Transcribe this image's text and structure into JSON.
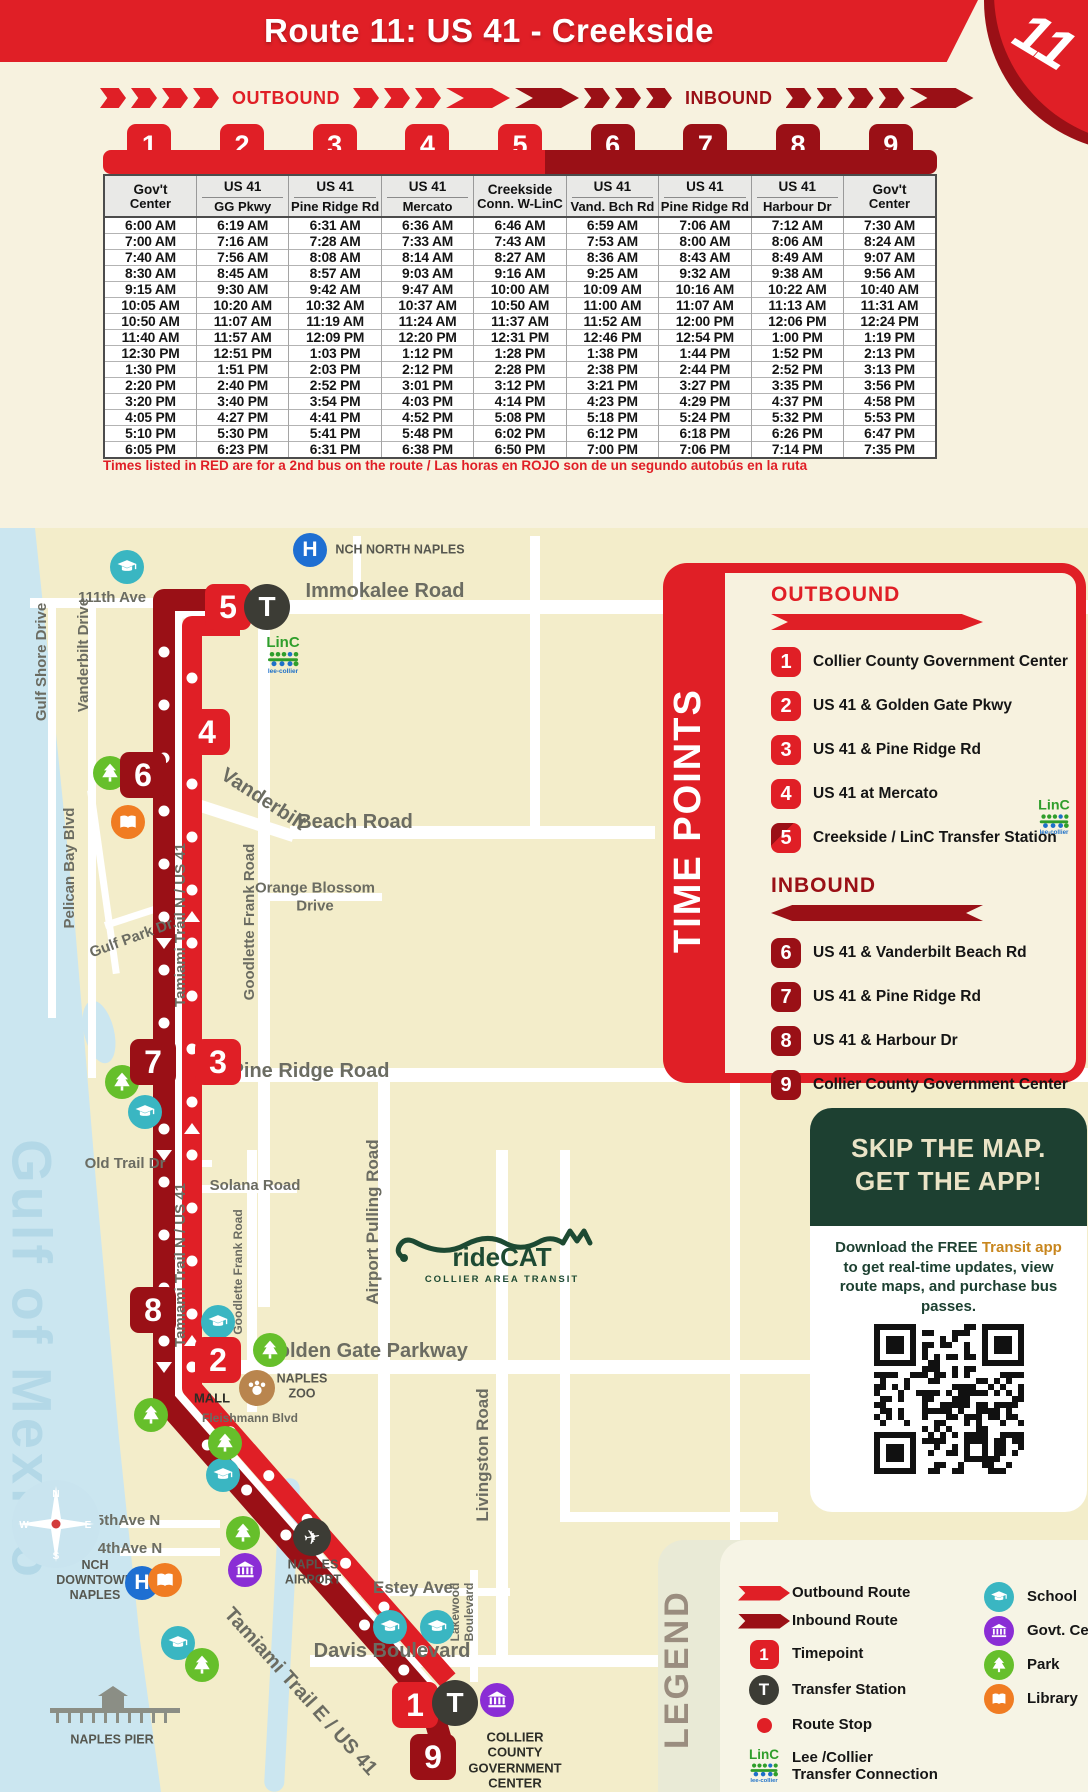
{
  "header": {
    "title": "Route 11: US 41 - Creekside",
    "route_number": "11"
  },
  "directions": {
    "outbound": "OUTBOUND",
    "inbound": "INBOUND"
  },
  "schedule": {
    "columns": [
      {
        "num": "1",
        "tone": "bright",
        "title": "Gov't",
        "subtitle": "Center",
        "divider": false
      },
      {
        "num": "2",
        "tone": "bright",
        "title": "US 41",
        "subtitle": "GG Pkwy",
        "divider": true
      },
      {
        "num": "3",
        "tone": "bright",
        "title": "US 41",
        "subtitle": "Pine Ridge Rd",
        "divider": true
      },
      {
        "num": "4",
        "tone": "bright",
        "title": "US 41",
        "subtitle": "Mercato",
        "divider": true
      },
      {
        "num": "5",
        "tone": "bright",
        "title": "Creekside",
        "subtitle": "Conn. W-LinC",
        "divider": false
      },
      {
        "num": "6",
        "tone": "dark",
        "title": "US 41",
        "subtitle": "Vand. Bch Rd",
        "divider": true
      },
      {
        "num": "7",
        "tone": "dark",
        "title": "US 41",
        "subtitle": "Pine Ridge Rd",
        "divider": true
      },
      {
        "num": "8",
        "tone": "dark",
        "title": "US 41",
        "subtitle": "Harbour Dr",
        "divider": true
      },
      {
        "num": "9",
        "tone": "dark",
        "title": "Gov't",
        "subtitle": "Center",
        "divider": false
      }
    ],
    "rows": [
      {
        "tone": "black",
        "times": [
          "6:00 AM",
          "6:19 AM",
          "6:31 AM",
          "6:36 AM",
          "6:46 AM",
          "6:59 AM",
          "7:06 AM",
          "7:12 AM",
          "7:30 AM"
        ]
      },
      {
        "tone": "red",
        "times": [
          "7:00 AM",
          "7:16 AM",
          "7:28 AM",
          "7:33 AM",
          "7:43 AM",
          "7:53 AM",
          "8:00 AM",
          "8:06 AM",
          "8:24 AM"
        ]
      },
      {
        "tone": "black",
        "times": [
          "7:40 AM",
          "7:56 AM",
          "8:08 AM",
          "8:14 AM",
          "8:27 AM",
          "8:36 AM",
          "8:43 AM",
          "8:49 AM",
          "9:07 AM"
        ]
      },
      {
        "tone": "red",
        "times": [
          "8:30 AM",
          "8:45 AM",
          "8:57 AM",
          "9:03 AM",
          "9:16 AM",
          "9:25 AM",
          "9:32 AM",
          "9:38 AM",
          "9:56 AM"
        ]
      },
      {
        "tone": "black",
        "times": [
          "9:15 AM",
          "9:30 AM",
          "9:42 AM",
          "9:47 AM",
          "10:00 AM",
          "10:09 AM",
          "10:16 AM",
          "10:22 AM",
          "10:40 AM"
        ]
      },
      {
        "tone": "red",
        "times": [
          "10:05 AM",
          "10:20 AM",
          "10:32 AM",
          "10:37 AM",
          "10:50 AM",
          "11:00 AM",
          "11:07 AM",
          "11:13 AM",
          "11:31 AM"
        ]
      },
      {
        "tone": "black",
        "times": [
          "10:50 AM",
          "11:07 AM",
          "11:19 AM",
          "11:24 AM",
          "11:37 AM",
          "11:52 AM",
          "12:00 PM",
          "12:06 PM",
          "12:24 PM"
        ]
      },
      {
        "tone": "red",
        "times": [
          "11:40 AM",
          "11:57 AM",
          "12:09 PM",
          "12:20 PM",
          "12:31 PM",
          "12:46 PM",
          "12:54 PM",
          "1:00 PM",
          "1:19 PM"
        ]
      },
      {
        "tone": "black",
        "times": [
          "12:30 PM",
          "12:51 PM",
          "1:03 PM",
          "1:12 PM",
          "1:28 PM",
          "1:38 PM",
          "1:44 PM",
          "1:52 PM",
          "2:13 PM"
        ]
      },
      {
        "tone": "red",
        "times": [
          "1:30 PM",
          "1:51 PM",
          "2:03 PM",
          "2:12 PM",
          "2:28 PM",
          "2:38 PM",
          "2:44 PM",
          "2:52 PM",
          "3:13 PM"
        ]
      },
      {
        "tone": "black",
        "times": [
          "2:20 PM",
          "2:40 PM",
          "2:52 PM",
          "3:01 PM",
          "3:12 PM",
          "3:21 PM",
          "3:27 PM",
          "3:35 PM",
          "3:56 PM"
        ]
      },
      {
        "tone": "red",
        "times": [
          "3:20 PM",
          "3:40 PM",
          "3:54 PM",
          "4:03 PM",
          "4:14 PM",
          "4:23 PM",
          "4:29 PM",
          "4:37 PM",
          "4:58 PM"
        ]
      },
      {
        "tone": "black",
        "times": [
          "4:05 PM",
          "4:27 PM",
          "4:41 PM",
          "4:52 PM",
          "5:08 PM",
          "5:18 PM",
          "5:24 PM",
          "5:32 PM",
          "5:53 PM"
        ]
      },
      {
        "tone": "red",
        "times": [
          "5:10 PM",
          "5:30 PM",
          "5:41 PM",
          "5:48 PM",
          "6:02 PM",
          "6:12 PM",
          "6:18 PM",
          "6:26 PM",
          "6:47 PM"
        ]
      },
      {
        "tone": "black",
        "times": [
          "6:05 PM",
          "6:23 PM",
          "6:31 PM",
          "6:38 PM",
          "6:50 PM",
          "7:00 PM",
          "7:06 PM",
          "7:14 PM",
          "7:35 PM"
        ]
      }
    ],
    "footnote": "Times listed in RED are for a 2nd bus on the route / Las horas en ROJO son de un segundo autobús en la ruta"
  },
  "time_points_panel": {
    "title": "TIME POINTS",
    "outbound_heading": "OUTBOUND",
    "inbound_heading": "INBOUND",
    "outbound": [
      {
        "num": "1",
        "label": "Collier County Government Center"
      },
      {
        "num": "2",
        "label": "US 41 & Golden Gate Pkwy"
      },
      {
        "num": "3",
        "label": "US 41 & Pine Ridge Rd"
      },
      {
        "num": "4",
        "label": "US 41 at Mercato"
      },
      {
        "num": "5",
        "label": "Creekside / LinC Transfer Station",
        "linc": true
      }
    ],
    "inbound": [
      {
        "num": "6",
        "label": "US 41 & Vanderbilt Beach Rd"
      },
      {
        "num": "7",
        "label": "US 41 & Pine Ridge Rd"
      },
      {
        "num": "8",
        "label": "US 41 & Harbour Dr"
      },
      {
        "num": "9",
        "label": "Collier County Government Center"
      }
    ]
  },
  "app_box": {
    "title_line1": "SKIP THE MAP.",
    "title_line2": "GET THE APP!",
    "body_prefix": "Download the FREE ",
    "body_highlight": "Transit app",
    "body_suffix": " to get real-time updates, view route maps, and purchase bus passes."
  },
  "legend": {
    "title": "LEGEND",
    "left": [
      {
        "icon": "outbound-arrow",
        "label": "Outbound Route"
      },
      {
        "icon": "inbound-arrow",
        "label": "Inbound Route"
      },
      {
        "icon": "timepoint",
        "label": "Timepoint",
        "glyph": "1"
      },
      {
        "icon": "transfer",
        "label": "Transfer Station",
        "glyph": "T"
      },
      {
        "icon": "stop",
        "label": "Route Stop"
      },
      {
        "icon": "linc",
        "label": "Lee /Collier\nTransfer Connection"
      }
    ],
    "right": [
      {
        "icon": "school",
        "label": "School"
      },
      {
        "icon": "govt",
        "label": "Govt. Center"
      },
      {
        "icon": "park",
        "label": "Park"
      },
      {
        "icon": "library",
        "label": "Library"
      }
    ]
  },
  "linc": {
    "word": "LinC",
    "sub": "lee-collier"
  },
  "ridecat": {
    "name": "rideCAT",
    "sub": "COLLIER AREA TRANSIT"
  },
  "map": {
    "water_name": "Gulf of Mexico",
    "compass": {
      "n": "N",
      "e": "E",
      "s": "S",
      "w": "W"
    },
    "labels": [
      {
        "text": "NCH NORTH NAPLES",
        "x": 400,
        "y": 550,
        "cls": "poi"
      },
      {
        "text": "111th Ave",
        "x": 112,
        "y": 598,
        "cls": "st"
      },
      {
        "text": "Immokalee Road",
        "x": 385,
        "y": 592,
        "cls": "st-lg"
      },
      {
        "text": "Gulf Shore Drive",
        "x": 42,
        "y": 662,
        "cls": "st",
        "rot": -90
      },
      {
        "text": "Vanderbilt Drive",
        "x": 84,
        "y": 655,
        "cls": "st",
        "rot": -90
      },
      {
        "text": "Vanderbilt",
        "x": 263,
        "y": 800,
        "cls": "st-lg",
        "rot": 33
      },
      {
        "text": "Beach Road",
        "x": 355,
        "y": 823,
        "cls": "st-lg"
      },
      {
        "text": "Pelican Bay Blvd",
        "x": 70,
        "y": 868,
        "cls": "st",
        "rot": -90
      },
      {
        "text": "Gulf Park Dr.",
        "x": 133,
        "y": 938,
        "cls": "st",
        "rot": -20
      },
      {
        "text": "Tamiami Trail N / US 41",
        "x": 181,
        "y": 925,
        "cls": "st",
        "rot": -90
      },
      {
        "text": "Goodlette Frank Road",
        "x": 250,
        "y": 922,
        "cls": "st",
        "rot": -90
      },
      {
        "text": "Orange Blossom\nDrive",
        "x": 315,
        "y": 897,
        "cls": "st"
      },
      {
        "text": "Pine Ridge Road",
        "x": 310,
        "y": 1072,
        "cls": "st-lg"
      },
      {
        "text": "Old Trail Dr",
        "x": 125,
        "y": 1164,
        "cls": "st"
      },
      {
        "text": "Solana Road",
        "x": 255,
        "y": 1186,
        "cls": "st"
      },
      {
        "text": "Tamiami Trail N / US 41",
        "x": 181,
        "y": 1265,
        "cls": "st",
        "rot": -90
      },
      {
        "text": "Goodlette Frank Road",
        "x": 238,
        "y": 1272,
        "cls": "st-xs",
        "rot": -90
      },
      {
        "text": "Airport Pulling Road",
        "x": 373,
        "y": 1222,
        "cls": "st-md",
        "rot": -90
      },
      {
        "text": "Golden Gate Parkway",
        "x": 365,
        "y": 1352,
        "cls": "st-lg"
      },
      {
        "text": "NAPLES\nZOO",
        "x": 302,
        "y": 1386,
        "cls": "poi"
      },
      {
        "text": "MALL",
        "x": 212,
        "y": 1398,
        "cls": "poi-dark"
      },
      {
        "text": "Fleishmann Blvd",
        "x": 250,
        "y": 1418,
        "cls": "st-xs"
      },
      {
        "text": "Livingston Road",
        "x": 483,
        "y": 1455,
        "cls": "st-md",
        "rot": -90
      },
      {
        "text": "5thAve N",
        "x": 128,
        "y": 1521,
        "cls": "st"
      },
      {
        "text": "4thAve N",
        "x": 130,
        "y": 1549,
        "cls": "st"
      },
      {
        "text": "NCH\nDOWNTOWN\nNAPLES",
        "x": 95,
        "y": 1580,
        "cls": "poi"
      },
      {
        "text": "NAPLES\nAIRPORT",
        "x": 313,
        "y": 1572,
        "cls": "poi"
      },
      {
        "text": "Estey Ave",
        "x": 413,
        "y": 1588,
        "cls": "st-md"
      },
      {
        "text": "Lakewood\nBoulevard",
        "x": 462,
        "y": 1612,
        "cls": "st-xs",
        "rot": -90
      },
      {
        "text": "Davis Boulevard",
        "x": 392,
        "y": 1652,
        "cls": "st-lg"
      },
      {
        "text": "Tamiami Trail E / US 41",
        "x": 300,
        "y": 1692,
        "cls": "st-lg",
        "rot": 48
      },
      {
        "text": "NAPLES PIER",
        "x": 112,
        "y": 1740,
        "cls": "poi"
      },
      {
        "text": "COLLIER\nCOUNTY\nGOVERNMENT\nCENTER",
        "x": 515,
        "y": 1760,
        "cls": "poi-dark"
      }
    ],
    "icons": [
      {
        "type": "hospital",
        "x": 310,
        "y": 550
      },
      {
        "type": "hospital",
        "x": 142,
        "y": 1583
      },
      {
        "type": "school",
        "x": 127,
        "y": 567
      },
      {
        "type": "school",
        "x": 145,
        "y": 1112
      },
      {
        "type": "school",
        "x": 218,
        "y": 1322
      },
      {
        "type": "school",
        "x": 223,
        "y": 1475
      },
      {
        "type": "school",
        "x": 390,
        "y": 1627
      },
      {
        "type": "school",
        "x": 437,
        "y": 1627
      },
      {
        "type": "school",
        "x": 178,
        "y": 1643
      },
      {
        "type": "park",
        "x": 110,
        "y": 773
      },
      {
        "type": "park",
        "x": 122,
        "y": 1082
      },
      {
        "type": "park",
        "x": 270,
        "y": 1350
      },
      {
        "type": "park",
        "x": 151,
        "y": 1415
      },
      {
        "type": "park",
        "x": 225,
        "y": 1443
      },
      {
        "type": "park",
        "x": 243,
        "y": 1533
      },
      {
        "type": "park",
        "x": 202,
        "y": 1665
      },
      {
        "type": "library",
        "x": 128,
        "y": 822
      },
      {
        "type": "library",
        "x": 165,
        "y": 1580
      },
      {
        "type": "govt",
        "x": 245,
        "y": 1570
      },
      {
        "type": "govt",
        "x": 497,
        "y": 1700
      },
      {
        "type": "plane",
        "x": 312,
        "y": 1537
      },
      {
        "type": "zoo",
        "x": 257,
        "y": 1388
      }
    ],
    "timepoints": [
      {
        "num": "5",
        "x": 228,
        "y": 607,
        "tone": "bright"
      },
      {
        "num": "4",
        "x": 207,
        "y": 732,
        "tone": "bright"
      },
      {
        "num": "6",
        "x": 143,
        "y": 775,
        "tone": "dark"
      },
      {
        "num": "7",
        "x": 153,
        "y": 1062,
        "tone": "dark"
      },
      {
        "num": "3",
        "x": 218,
        "y": 1062,
        "tone": "bright"
      },
      {
        "num": "8",
        "x": 153,
        "y": 1310,
        "tone": "dark"
      },
      {
        "num": "2",
        "x": 218,
        "y": 1360,
        "tone": "bright"
      },
      {
        "num": "1",
        "x": 415,
        "y": 1705,
        "tone": "bright"
      },
      {
        "num": "9",
        "x": 433,
        "y": 1757,
        "tone": "dark"
      }
    ],
    "stations": [
      {
        "x": 267,
        "y": 607
      },
      {
        "x": 455,
        "y": 1703
      }
    ],
    "linc_marks": [
      {
        "x": 283,
        "y": 655
      }
    ]
  }
}
